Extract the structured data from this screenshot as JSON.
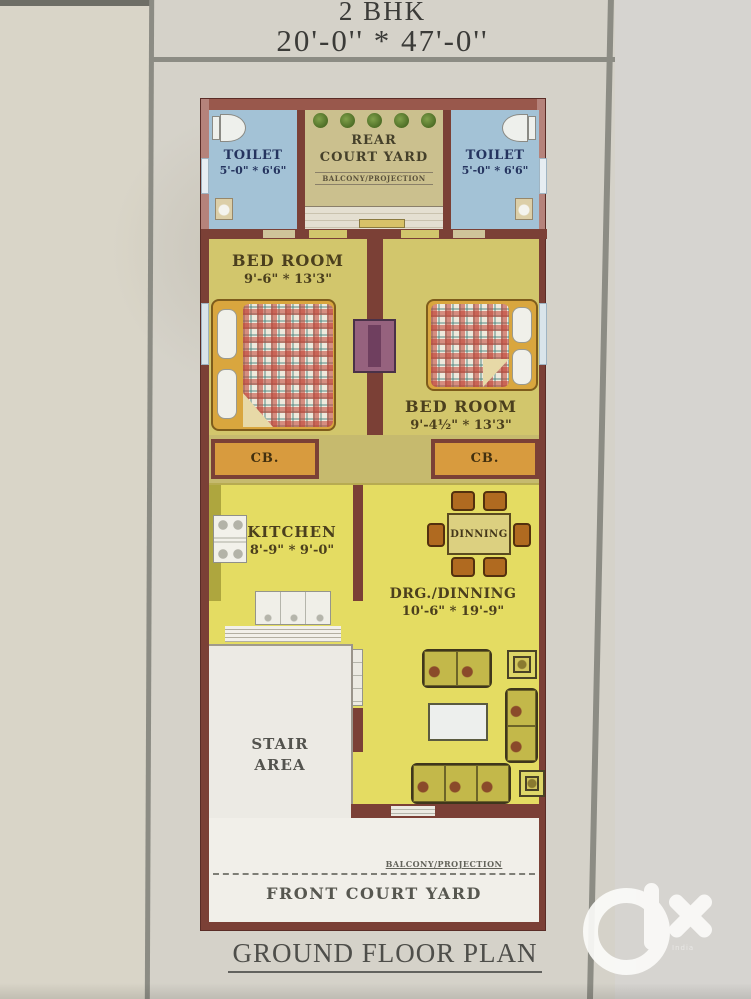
{
  "header": {
    "bhk": "2 BHK",
    "size": "20'-0'' * 47'-0''"
  },
  "plan": {
    "toilet_left": {
      "name": "TOILET",
      "dims": "5'-0\" * 6'6\""
    },
    "toilet_right": {
      "name": "TOILET",
      "dims": "5'-0\" * 6'6\""
    },
    "rear_courtyard": {
      "name_line1": "REAR",
      "name_line2": "COURT YARD",
      "balcony": "BALCONY/PROJECTION"
    },
    "bedroom_left": {
      "name": "BED ROOM",
      "dims": "9'-6\" * 13'3\""
    },
    "bedroom_right": {
      "name": "BED ROOM",
      "dims": "9'-4½\" * 13'3\""
    },
    "cupboard_left": "CB.",
    "cupboard_right": "CB.",
    "kitchen": {
      "name": "KITCHEN",
      "dims": "8'-9\" * 9'-0\""
    },
    "dining_table_label": "DINNING",
    "drawing_dining": {
      "name": "DRG./DINNING",
      "dims": "10'-6\" * 19'-9\""
    },
    "stair": {
      "line1": "STAIR",
      "line2": "AREA"
    },
    "front_balcony": "BALCONY/PROJECTION",
    "front_courtyard": "FRONT COURT YARD"
  },
  "footer": {
    "plan_title": "GROUND FLOOR PLAN"
  },
  "watermark": {
    "brand": "olx",
    "caption": "India"
  },
  "colors": {
    "wall": "#7b4036",
    "toilet_floor": "#a3c2d6",
    "bedroom_floor": "#d2c66c",
    "hall_floor": "#e4dc62",
    "courtyard_floor": "#cbc08e",
    "cupboard": "#d89b3e"
  }
}
